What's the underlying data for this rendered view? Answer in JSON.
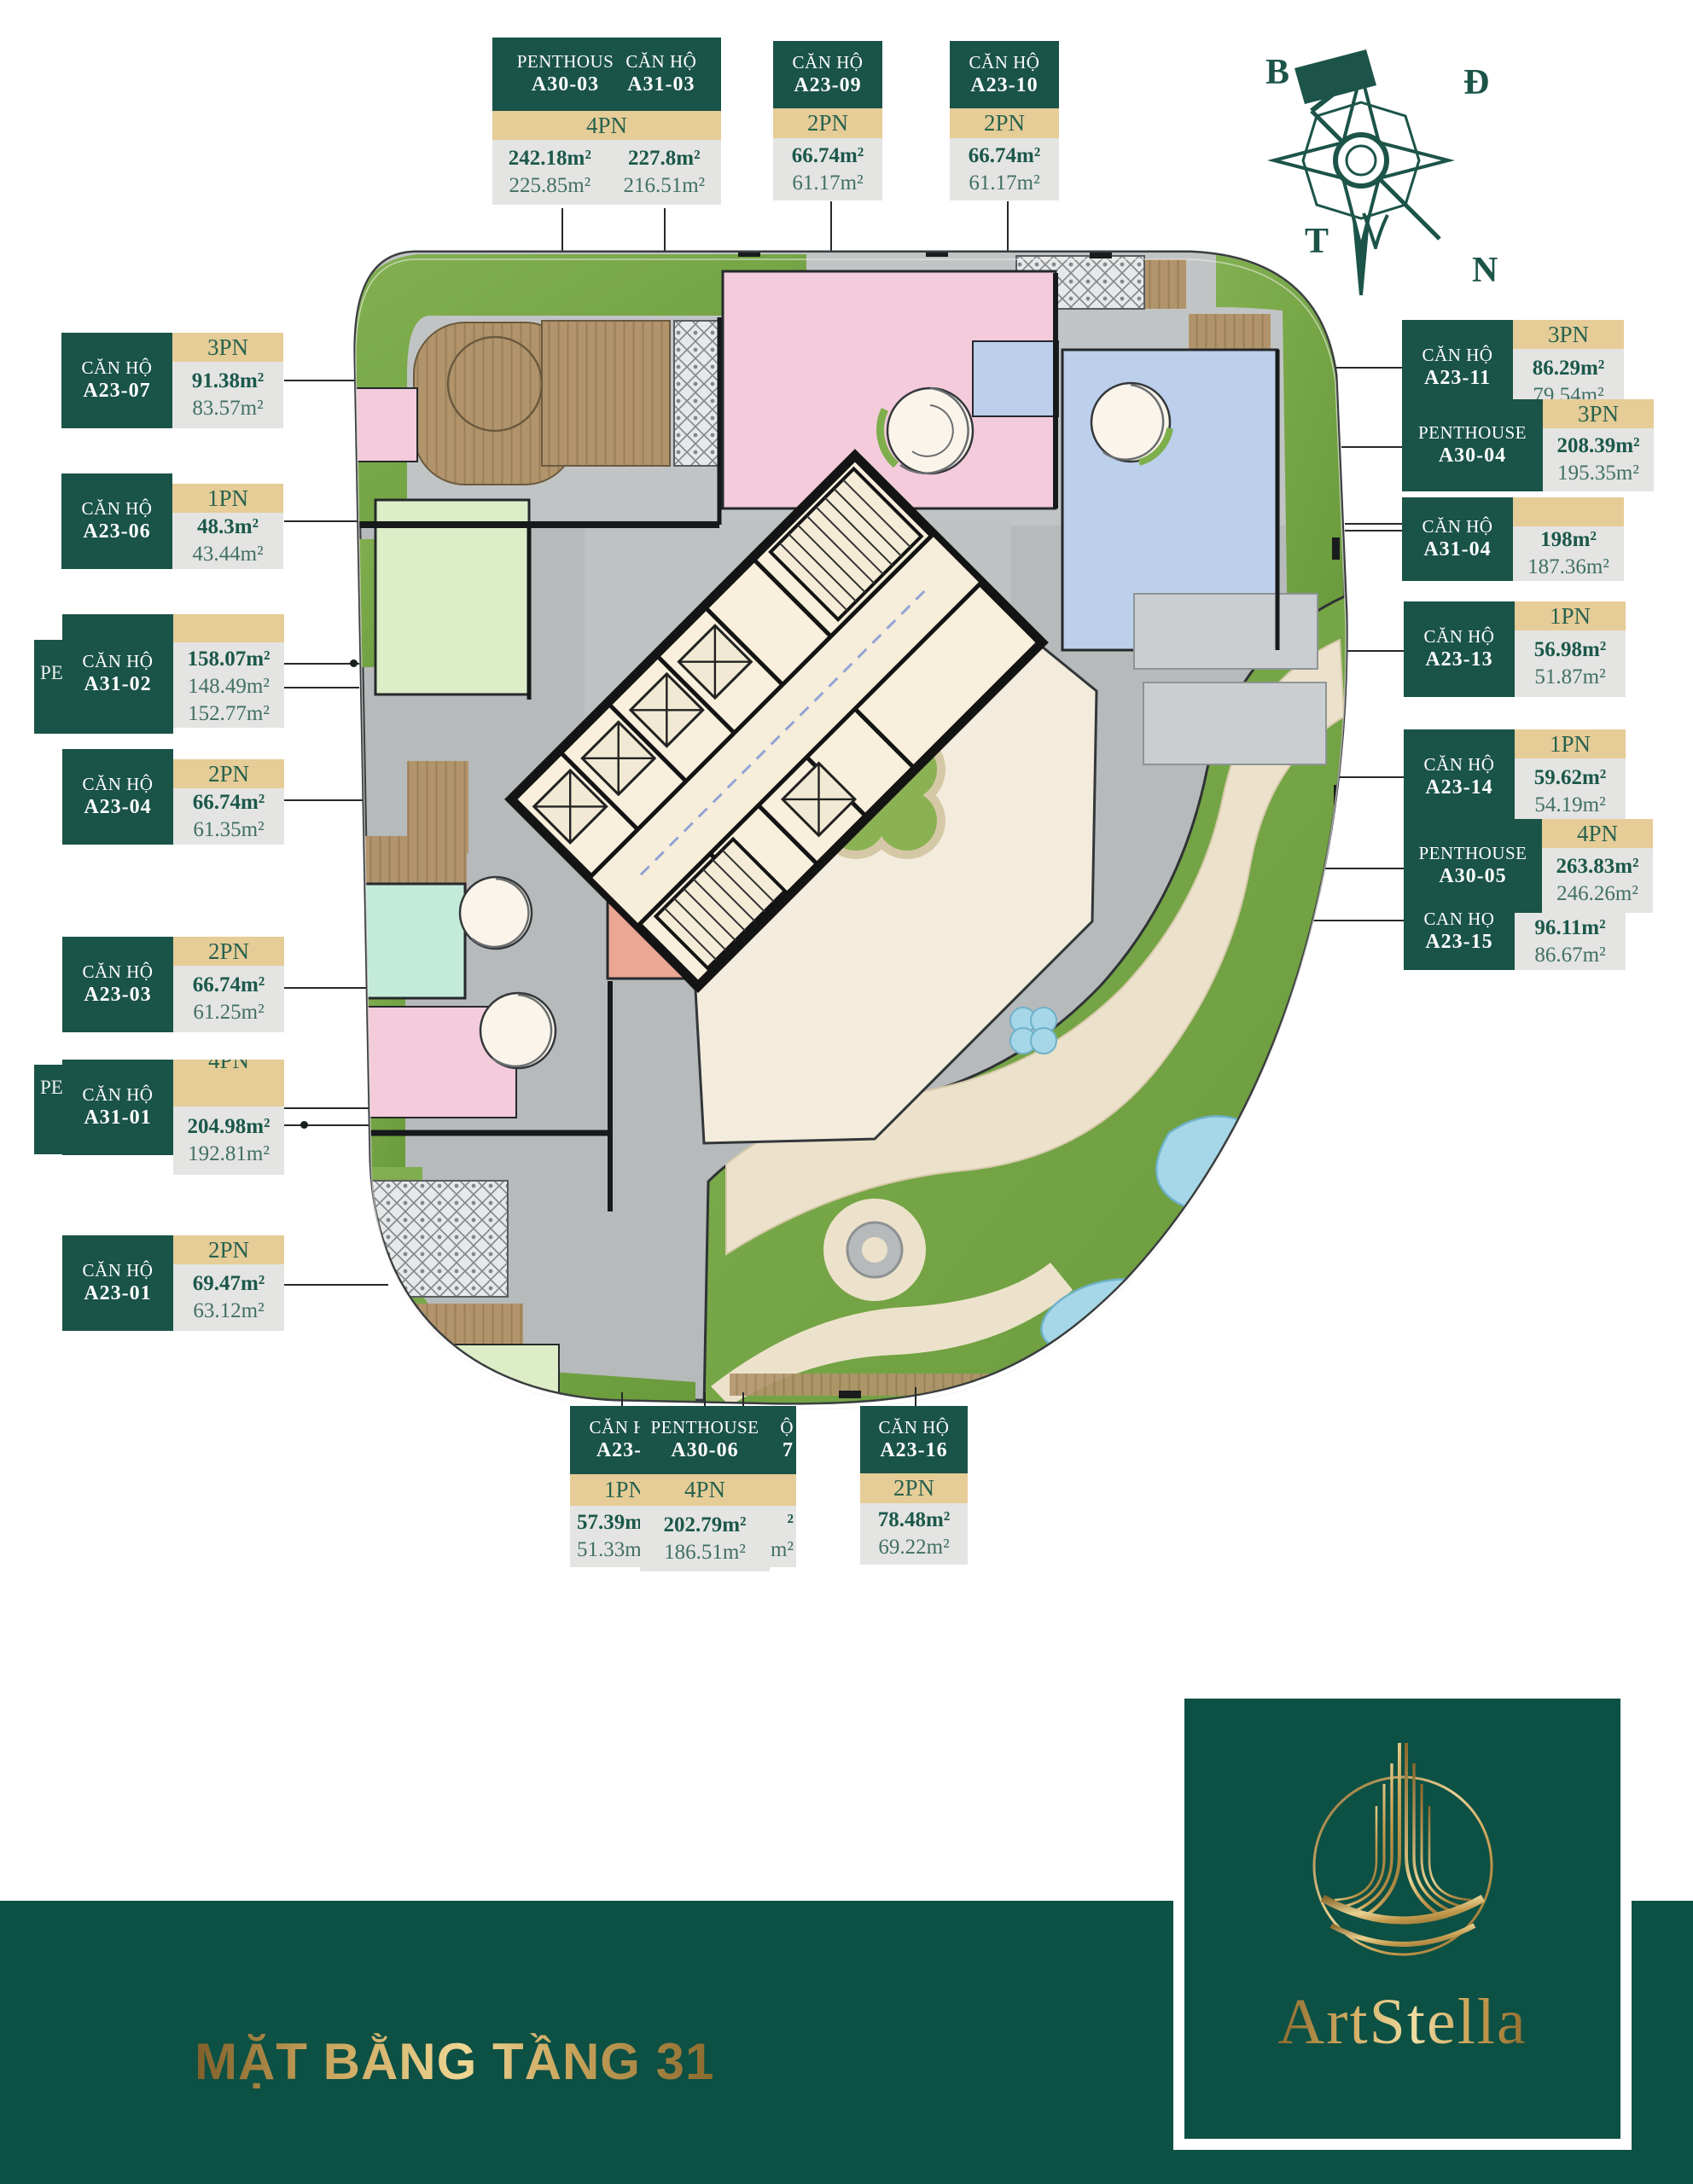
{
  "footer": {
    "title": "MẶT BẰNG TẦNG 31",
    "brand": "ArtStella"
  },
  "compass": {
    "north": "B",
    "east": "Đ",
    "west": "T",
    "south": "N"
  },
  "colors": {
    "label_green": "#1a5348",
    "band_tan": "#e6cc97",
    "value_grey": "#e4e4e3",
    "footer_green": "#0d5044",
    "gold": "#c9a45c",
    "plan_grey": "#b7babb",
    "grass_green": "#74a344",
    "courtyard_cream": "#f3ecdc",
    "core_beige": "#f8efdc",
    "apartment_pink": "#f3cbdb",
    "apartment_blue": "#bccfeb",
    "apartment_green": "#dcedc8",
    "apartment_mint": "#c4ebd9",
    "apartment_salmon": "#eca794",
    "pond_blue": "#a6d7e8"
  },
  "units": {
    "top": [
      {
        "titles": [
          "PENTHOUS",
          "CĂN HỘ"
        ],
        "codes": [
          "A30-03",
          "A31-03"
        ],
        "pn": "4PN",
        "areas": [
          {
            "gross": "242.18m²",
            "net": "225.85m²"
          },
          {
            "gross": "227.8m²",
            "net": "216.51m²"
          }
        ]
      },
      {
        "title": "CĂN HỘ",
        "code": "A23-09",
        "pn": "2PN",
        "gross": "66.74m²",
        "net": "61.17m²"
      },
      {
        "title": "CĂN HỘ",
        "code": "A23-10",
        "pn": "2PN",
        "gross": "66.74m²",
        "net": "61.17m²"
      }
    ],
    "left": [
      {
        "title": "CĂN HỘ",
        "code": "A23-07",
        "pn": "3PN",
        "gross": "91.38m²",
        "net": "83.57m²"
      },
      {
        "title": "CĂN HỘ",
        "code": "A23-06",
        "pn": "1PN",
        "gross": "48.3m²",
        "net": "43.44m²"
      },
      {
        "title": "CĂN HỘ",
        "code": "A31-02",
        "pn": "",
        "pe": "PE",
        "gross": "158.07m²",
        "net": "148.49m²",
        "extra": "152.77m²"
      },
      {
        "title": "CĂN HỘ",
        "code": "A23-04",
        "pn": "2PN",
        "gross": "66.74m²",
        "net": "61.35m²"
      },
      {
        "title": "CĂN HỘ",
        "code": "A23-03",
        "pn": "2PN",
        "gross": "66.74m²",
        "net": "61.25m²"
      },
      {
        "title": "CĂN HỘ",
        "code": "A31-01",
        "pn": "4PN",
        "pe": "PE",
        "gross": "204.98m²",
        "net": "192.81m²"
      },
      {
        "title": "CĂN HỘ",
        "code": "A23-01",
        "pn": "2PN",
        "gross": "69.47m²",
        "net": "63.12m²"
      }
    ],
    "right": [
      {
        "title": "CĂN HỘ",
        "code": "A23-11",
        "pn": "3PN",
        "gross": "86.29m²",
        "net": "79.54m²"
      },
      {
        "title": "PENTHOUSE",
        "code": "A30-04",
        "pn": "3PN",
        "gross": "208.39m²",
        "net": "195.35m²"
      },
      {
        "title": "CĂN HỘ",
        "code": "A31-04",
        "pn": "",
        "gross": "198m²",
        "net": "187.36m²"
      },
      {
        "title": "CĂN HỘ",
        "code": "A23-13",
        "pn": "1PN",
        "gross": "56.98m²",
        "net": "51.87m²"
      },
      {
        "title": "CĂN HỘ",
        "code": "A23-14",
        "pn": "1PN",
        "gross": "59.62m²",
        "net": "54.19m²"
      },
      {
        "title": "PENTHOUSE",
        "code": "A30-05",
        "pn": "4PN",
        "gross": "263.83m²",
        "net": "246.26m²"
      },
      {
        "title": "CĂN HỘ",
        "code": "A23-15",
        "pn": "",
        "gross": "96.11m²",
        "net": "86.67m²"
      }
    ],
    "bottom": [
      {
        "title": "CĂN HỘ",
        "code": "A23-1",
        "pn": "1PN",
        "gross": "57.39m²",
        "net": "51.33m²"
      },
      {
        "title": "PENTHOUSE",
        "code": "A30-06",
        "pn": "4PN",
        "gross": "202.79m²",
        "net": "186.51m²",
        "remnants": [
          "Ộ",
          "7",
          "²",
          "m²"
        ]
      },
      {
        "title": "CĂN HỘ",
        "code": "A23-16",
        "pn": "2PN",
        "gross": "78.48m²",
        "net": "69.22m²"
      }
    ]
  }
}
